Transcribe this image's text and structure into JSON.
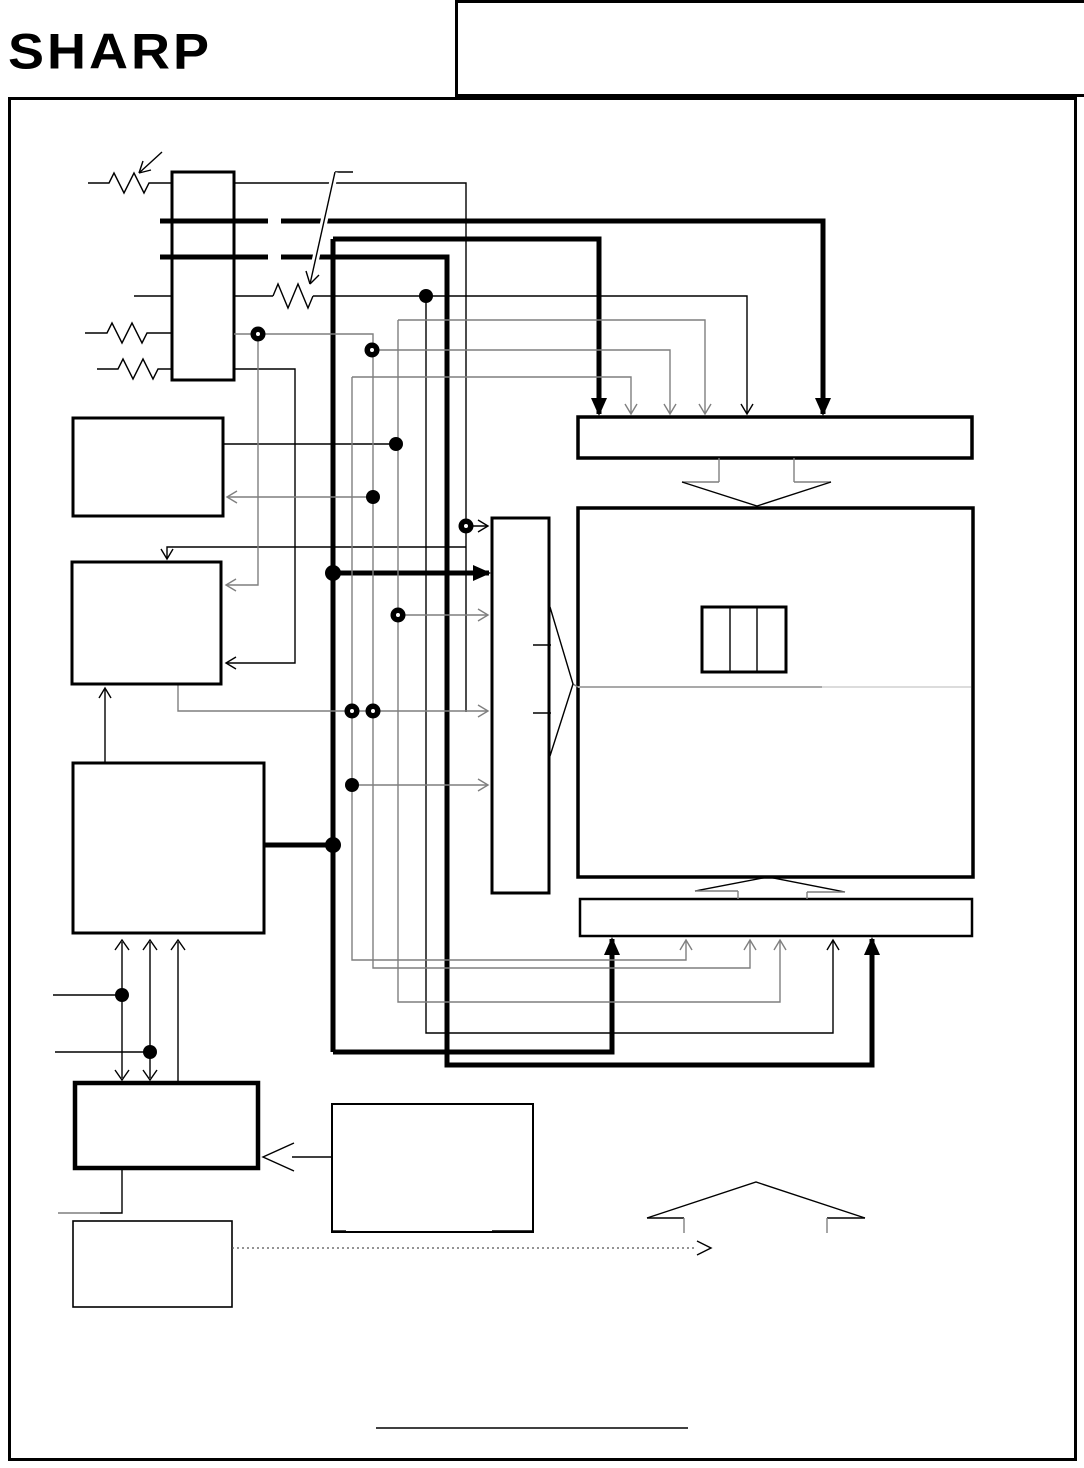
{
  "logo": {
    "text": "SHARP"
  },
  "header": {
    "cells": [
      {
        "label": ""
      },
      {
        "label": ""
      },
      {
        "label": ""
      }
    ]
  },
  "colors": {
    "ink": "#000000",
    "line_gray": "#7f7f7f",
    "divider_left": "#a9a9a9",
    "divider_right": "#dcdcdc",
    "dotted_line": "#555555",
    "paper": "#ffffff"
  }
}
